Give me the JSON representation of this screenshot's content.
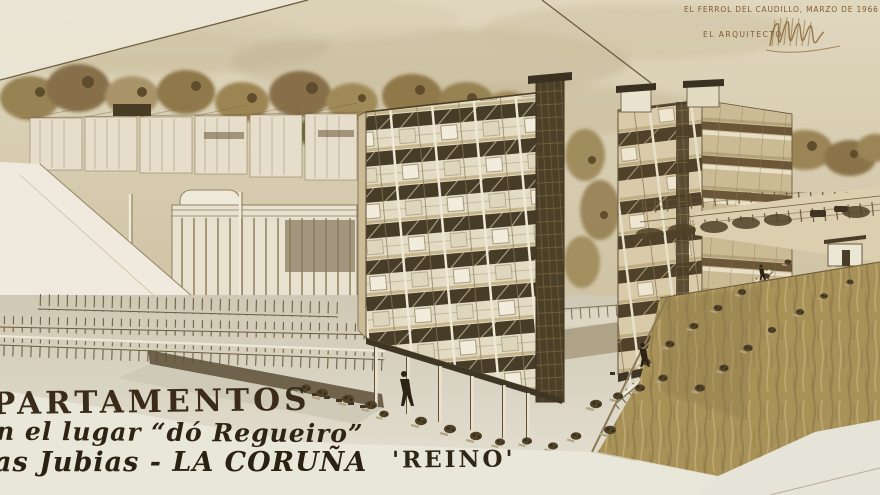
{
  "document": {
    "location_date": "EL FERROL DEL CAUDILLO, MARZO DE 1966",
    "architect_caption": "EL ARQUITECTO",
    "title_line1": "PARTAMENTOS",
    "title_line2": "n el lugar “dó Regueiro”",
    "title_line3": "as Jubias - LA CORUÑA",
    "project_name": "'REINO'"
  },
  "palette": {
    "paper": "#e7dfca",
    "sky": "#d2c7aa",
    "trees": "#8f7848",
    "ink_linework": "#4a3b24",
    "facade_cream": "#e3dbc4",
    "window_band": "#473c28",
    "stair_tower": "#4c3f28",
    "water": "#a99257",
    "plaza": "#d8d2c1",
    "margin_paper": "#e9e6da",
    "lettering": "#3a2c18",
    "caption_text": "#7f5c33"
  }
}
